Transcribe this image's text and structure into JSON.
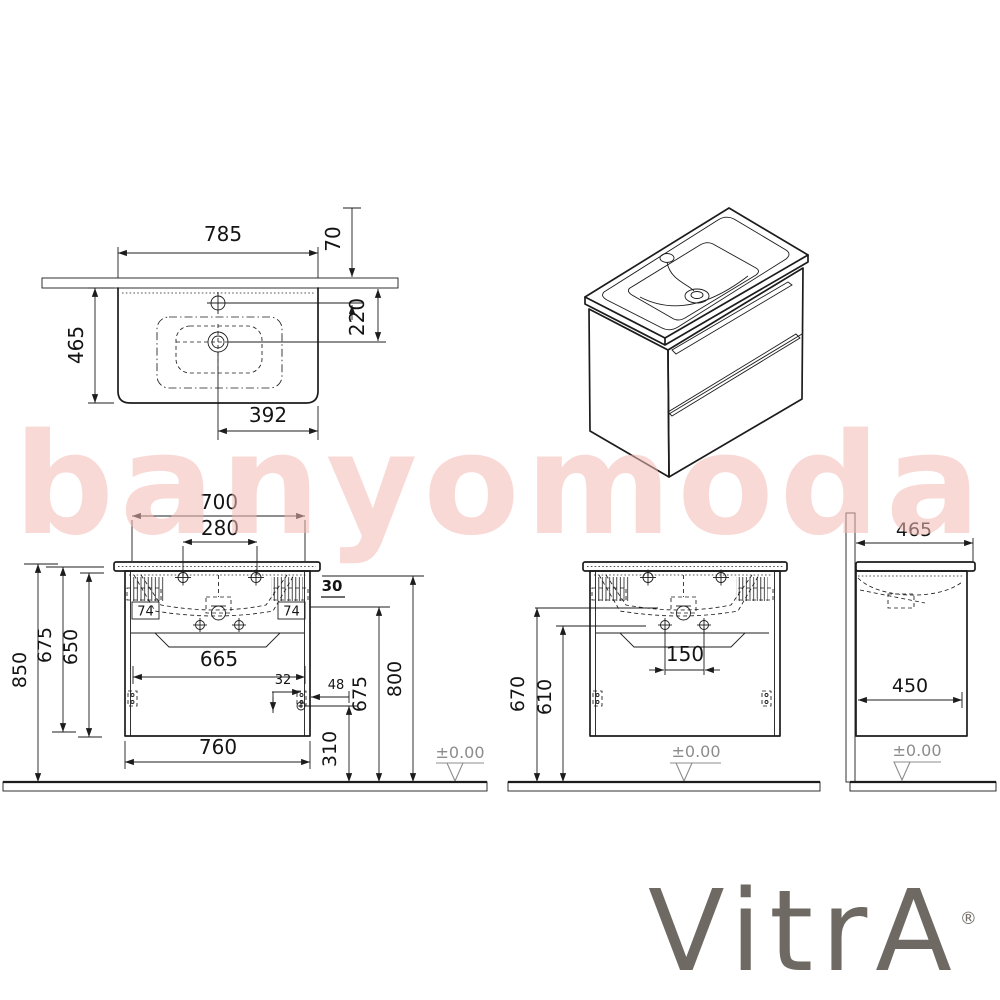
{
  "watermark": {
    "text": "banyomoda"
  },
  "brand": {
    "name": "VitrA",
    "registered_mark": "®"
  },
  "plan_view": {
    "width": "785",
    "back_offset": "70",
    "depth": "465",
    "drain_from_wall": "220",
    "drain_to_edge": "392"
  },
  "front_view": {
    "basin_width": "700",
    "tap_hole_spacing": "280",
    "top_gap": "30",
    "bracket_left": "74",
    "bracket_right": "74",
    "total_height": "850",
    "cabinet_height": "675",
    "body_height": "650",
    "drawer_inner_width": "665",
    "handle_offset": "32",
    "handle_side_offset": "48",
    "fixing_height": "675",
    "countertop_height": "800",
    "drawer_bottom_height": "310",
    "cabinet_width": "760",
    "datum": "±0.00"
  },
  "front_view_2": {
    "drain_height": "670",
    "fixing_holes_height": "610",
    "fixing_hole_spacing": "150",
    "datum": "±0.00"
  },
  "side_view": {
    "top_depth": "465",
    "body_depth": "450",
    "datum": "±0.00"
  }
}
